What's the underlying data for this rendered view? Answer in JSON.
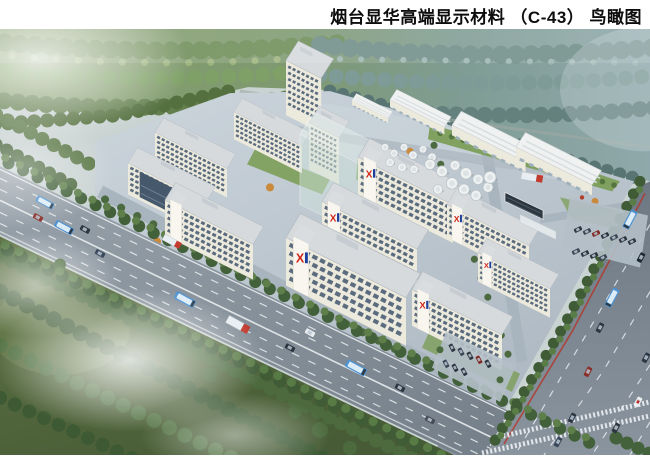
{
  "title": {
    "text": "烟台显华高端显示材料 （C-43） 鸟瞰图"
  },
  "rendering": {
    "type": "aerial bird's-eye architectural rendering",
    "subject": "industrial campus of white multi-story buildings between a tree-lined boulevard, a highway and forests",
    "logo": {
      "glyph": "X"
    },
    "colors": {
      "wall": "#ece9dd",
      "wall_light": "#f7f4ea",
      "win": "#5b6c7e",
      "roof": "#d6dadd",
      "lawn": "#7c9e58",
      "bus_blue": "#4f93d2",
      "logo_red": "#d02818",
      "logo_blue": "#1d3f9c",
      "tree_dark": "#42603a",
      "tree_mid": "#5e7f4a",
      "pavement": "#bcc7d0",
      "glass": "#46586b"
    }
  }
}
